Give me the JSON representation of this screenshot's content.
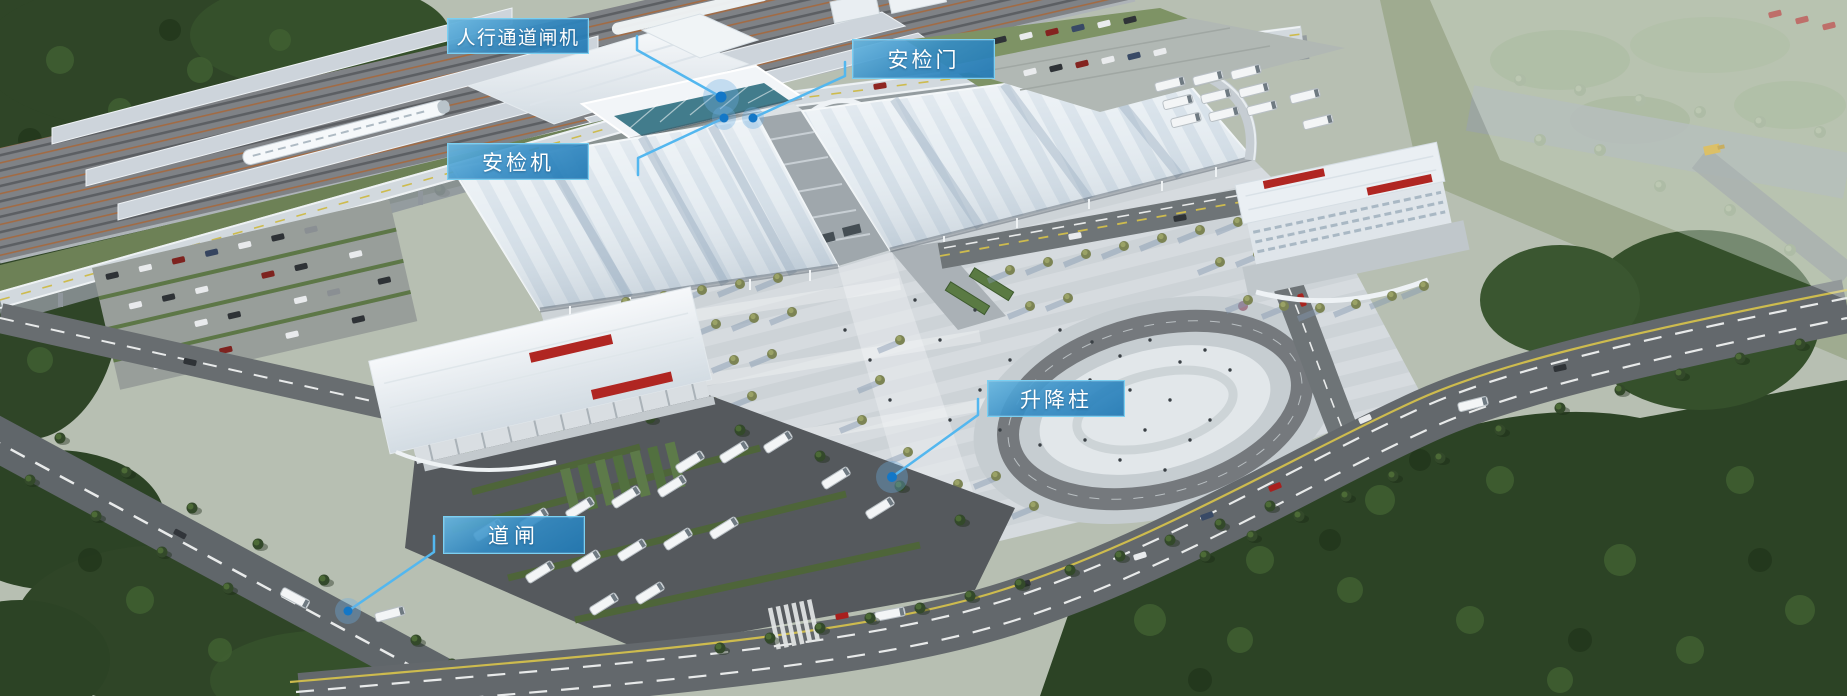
{
  "scene": {
    "subject": "railway-station-aerial-render"
  },
  "annotations": [
    {
      "id": "pedestrian-gate",
      "label": "人行通道闸机"
    },
    {
      "id": "security-door",
      "label": "安检门"
    },
    {
      "id": "security-scanner",
      "label": "安检机"
    },
    {
      "id": "lifting-bollard",
      "label": "升降柱"
    },
    {
      "id": "road-barrier",
      "label": "道闸"
    }
  ],
  "colors": {
    "label_background_top": "#68b7e0",
    "label_background_bottom": "#2179b4",
    "label_border": "#7ad0f2",
    "label_text": "#ffffff",
    "leader_line": "#53b7ef",
    "marker_dot": "#1377c7",
    "marker_halo": "rgba(110,175,225,0.35)"
  }
}
